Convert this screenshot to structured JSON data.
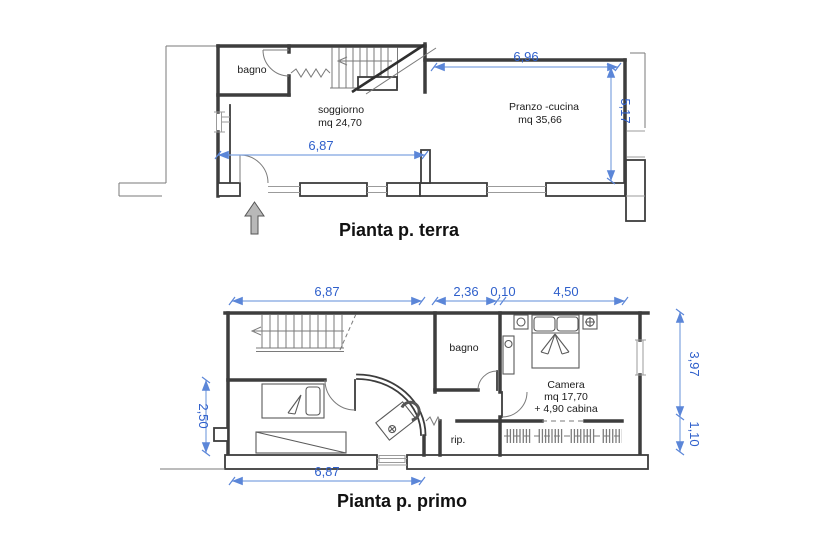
{
  "colors": {
    "wall": "#3d3d3d",
    "thin_line": "#9b9b9b",
    "dimension_line": "#7fa3e0",
    "dimension_text": "#2e5fcb",
    "label_text": "#1b1b1b",
    "title_text": "#111111",
    "entrance_arrow_fill": "#b8b8b8"
  },
  "ground_floor": {
    "title": "Pianta p. terra",
    "labels": {
      "bagno": "bagno",
      "soggiorno": "soggiorno",
      "soggiorno_area": "mq 24,70",
      "pranzo": "Pranzo -cucina",
      "pranzo_area": "mq 35,66"
    },
    "dimensions": {
      "width_top": "6,96",
      "height_right": "5,17",
      "width_mid": "6,87"
    }
  },
  "first_floor": {
    "title": "Pianta p. primo",
    "labels": {
      "bagno": "bagno",
      "camera": "Camera",
      "camera_area": "mq 17,70",
      "camera_extra": "+ 4,90 cabina",
      "rip": "rip."
    },
    "dimensions": {
      "width_top": "6,87",
      "bagno_width": "2,36",
      "wall_thickness": "0,10",
      "camera_width": "4,50",
      "height_left": "2,50",
      "height_right_upper": "3,97",
      "height_right_lower": "1,10",
      "width_bottom": "6,87"
    }
  }
}
